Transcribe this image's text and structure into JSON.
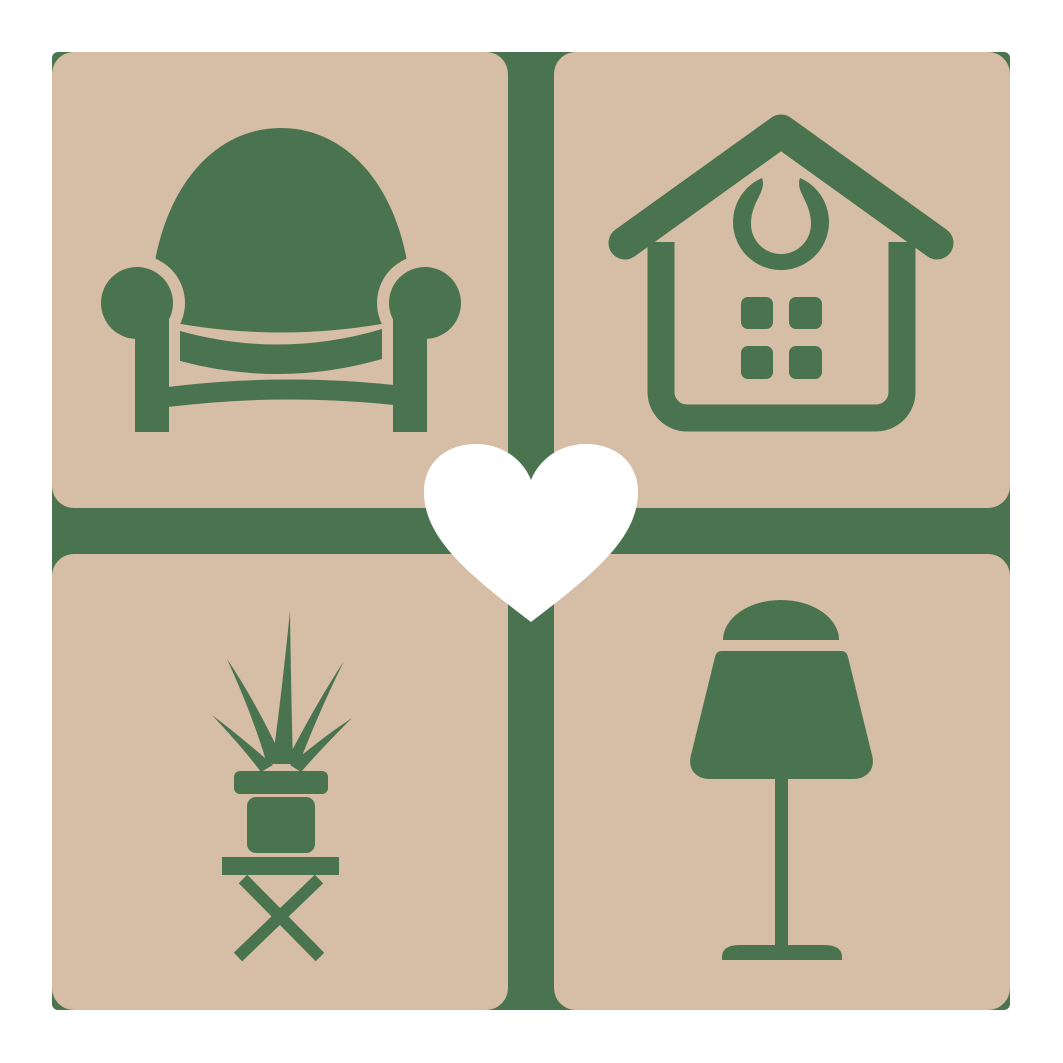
{
  "page": {
    "background": "#ffffff"
  },
  "logo": {
    "colors": {
      "page-bg": "#ffffff",
      "tile-color": "#d6bda5",
      "icon-color": "#4a7350",
      "heart-color": "#ffffff"
    },
    "grid": {
      "rows": 2,
      "cols": 2
    },
    "tiles": [
      {
        "position": "top-left",
        "icon": "armchair-icon",
        "subject": "armchair"
      },
      {
        "position": "top-right",
        "icon": "house-icon",
        "subject": "house with round window ornament and four-pane window"
      },
      {
        "position": "bottom-left",
        "icon": "potted-plant-icon",
        "subject": "spiky potted plant on cross-leg stool"
      },
      {
        "position": "bottom-right",
        "icon": "table-lamp-icon",
        "subject": "table lamp with dome finial"
      }
    ],
    "center": {
      "icon": "heart-icon",
      "subject": "heart"
    }
  }
}
